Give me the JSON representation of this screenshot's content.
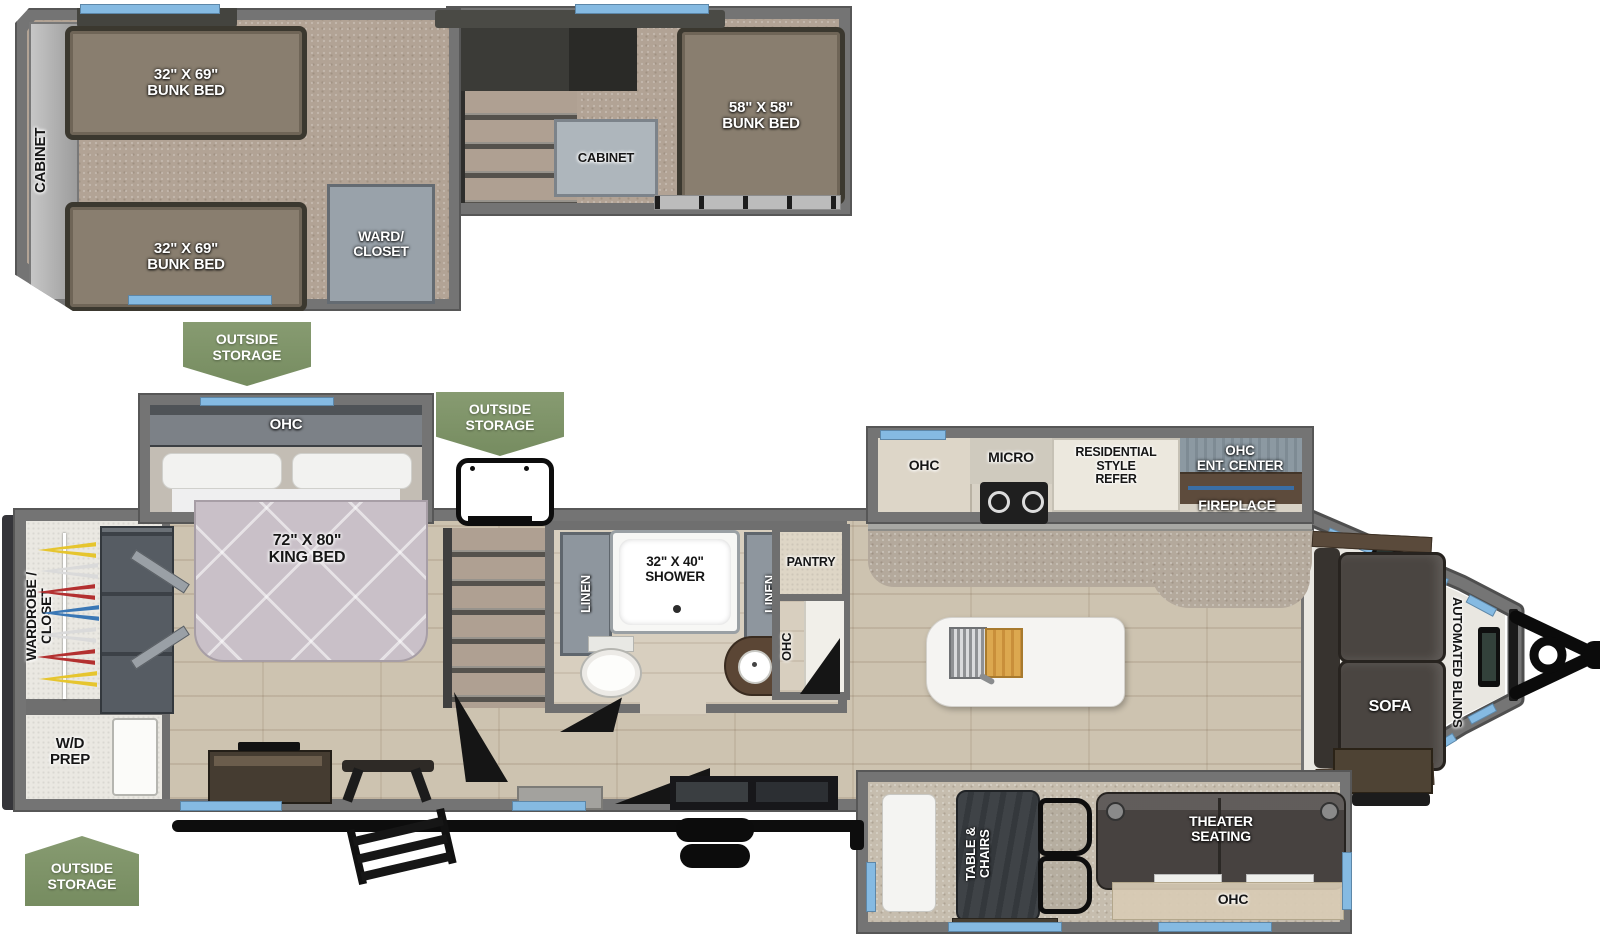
{
  "floorplan": {
    "loft": {
      "cabinet_left": "CABINET",
      "bunk_top": "32\" X 69\"\nBUNK BED",
      "bunk_bottom": "32\" X 69\"\nBUNK BED",
      "ward_closet": "WARD/\nCLOSET",
      "cabinet_mid": "CABINET",
      "bunk_rear": "58\" X 58\"\nBUNK BED"
    },
    "badges": {
      "outside_storage": "OUTSIDE\nSTORAGE"
    },
    "bedroom": {
      "ohc": "OHC",
      "king_bed": "72\" X 80\"\nKING BED",
      "wardrobe_closet": "WARDROBE /\nCLOSET",
      "wd_prep": "W/D\nPREP"
    },
    "bathroom": {
      "linen": "LINEN",
      "shower": "32\" X 40\"\nSHOWER"
    },
    "kitchen": {
      "pantry": "PANTRY",
      "ohc_column": "OHC",
      "ohc": "OHC",
      "micro": "MICRO",
      "refer": "RESIDENTIAL\nSTYLE\nREFER"
    },
    "living": {
      "ohc_ent_center": "OHC\nENT. CENTER",
      "fireplace": "FIREPLACE",
      "sofa": "SOFA",
      "automated_blinds": "AUTOMATED BLINDS",
      "theater_seating": "THEATER\nSEATING",
      "ohc": "OHC"
    },
    "dinette": {
      "table_chairs": "TABLE &\nCHAIRS"
    },
    "colors": {
      "badge_green": "#7f9569",
      "wall_gray": "#747474",
      "window_blue": "#85bae2"
    }
  }
}
